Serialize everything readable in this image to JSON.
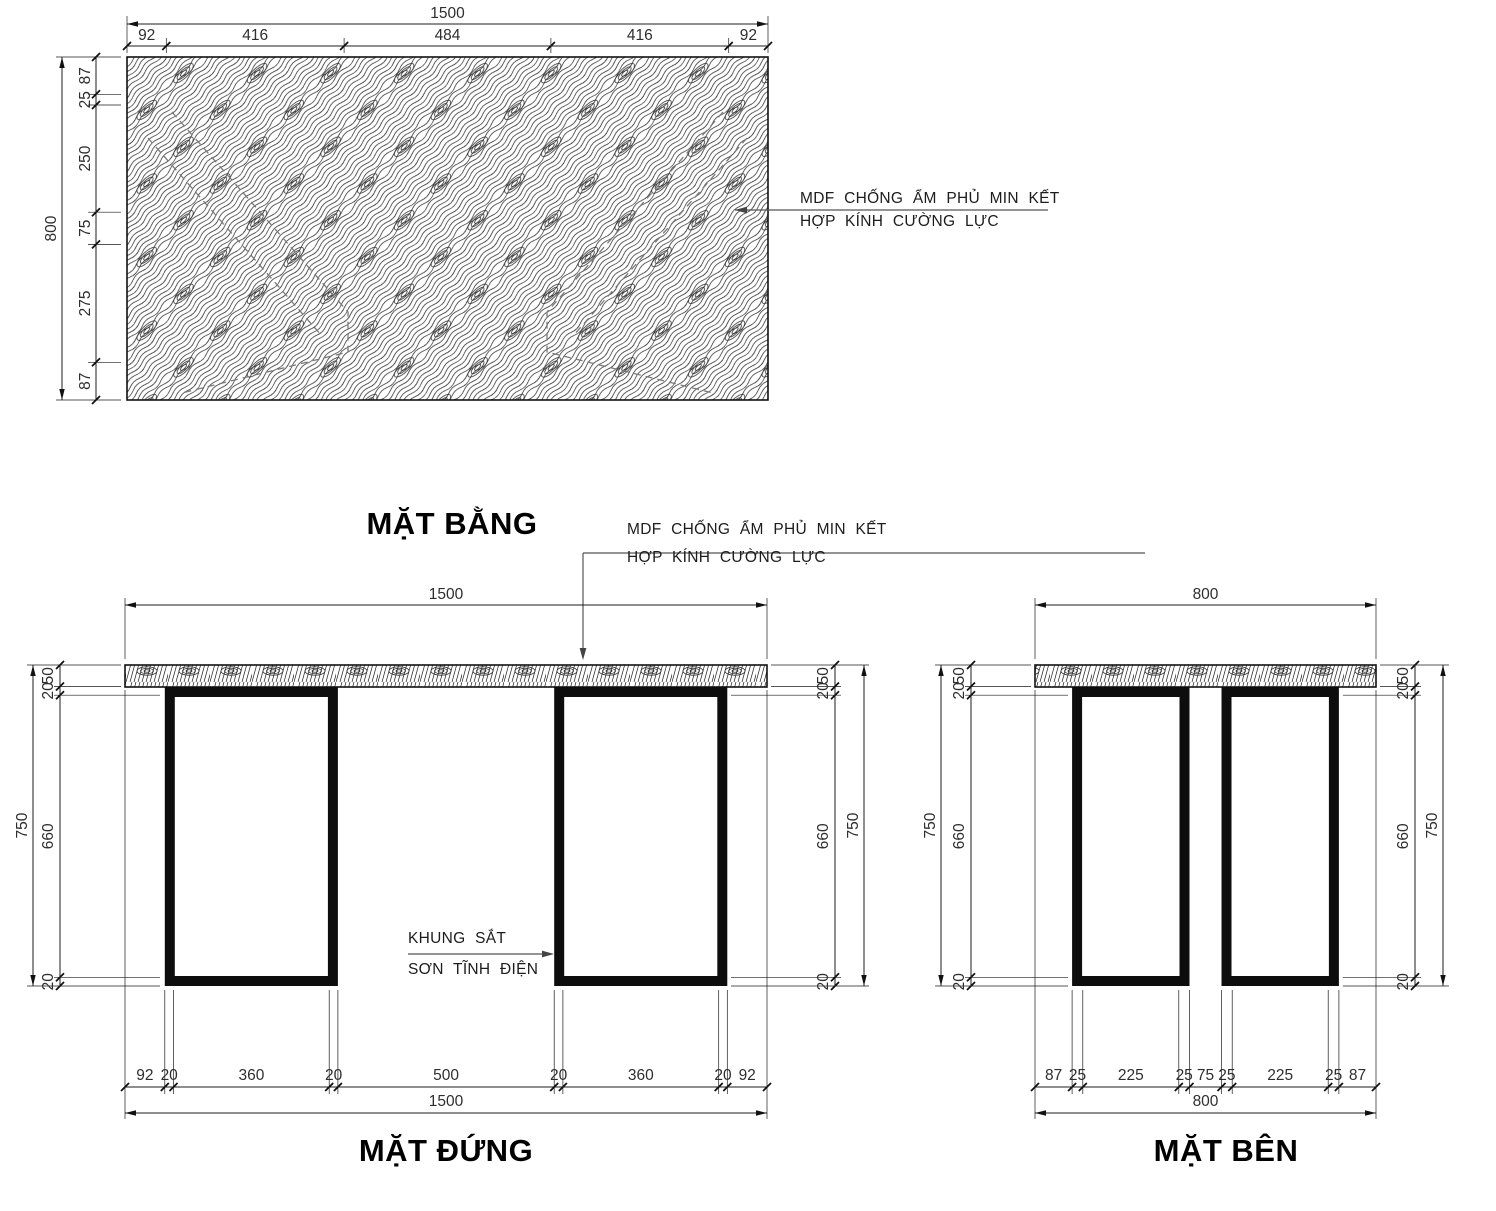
{
  "plan": {
    "title": "MẶT BẰNG",
    "top_total": "1500",
    "top_segments": [
      "92",
      "416",
      "484",
      "416",
      "92"
    ],
    "left_total": "800",
    "left_segments": [
      "87",
      "25",
      "250",
      "75",
      "275",
      "87"
    ],
    "note": {
      "line1": "MDF CHỐNG ẨM PHỦ MIN KẾT",
      "line2": "HỢP KÍNH CƯỜNG LỰC"
    }
  },
  "front": {
    "title": "MẶT ĐỨNG",
    "top_total": "1500",
    "bottom_total": "1500",
    "bottom_segments": [
      "92",
      "20",
      "360",
      "20",
      "500",
      "20",
      "360",
      "20",
      "92"
    ],
    "height_total": "750",
    "height_segments": [
      "50",
      "20",
      "660",
      "20"
    ],
    "top_note": {
      "line1": "MDF CHỐNG ẨM PHỦ MIN KẾT",
      "line2": "HỢP KÍNH CƯỜNG LỰC"
    },
    "leg_note": {
      "line1": "KHUNG SẮT",
      "line2": "SƠN TĨNH ĐIỆN"
    }
  },
  "side": {
    "title": "MẶT BÊN",
    "top_total": "800",
    "bottom_total": "800",
    "bottom_segments": [
      "87",
      "25",
      "225",
      "25",
      "75",
      "25",
      "225",
      "25",
      "87"
    ],
    "height_total": "750",
    "height_segments": [
      "50",
      "20",
      "660",
      "20"
    ]
  },
  "colors": {
    "line": "#1c1c1c",
    "dim_text": "#2e2e2e",
    "hidden_line": "#7a7a7a",
    "leader": "#555555",
    "leg_fill": "#0d0d0d"
  }
}
